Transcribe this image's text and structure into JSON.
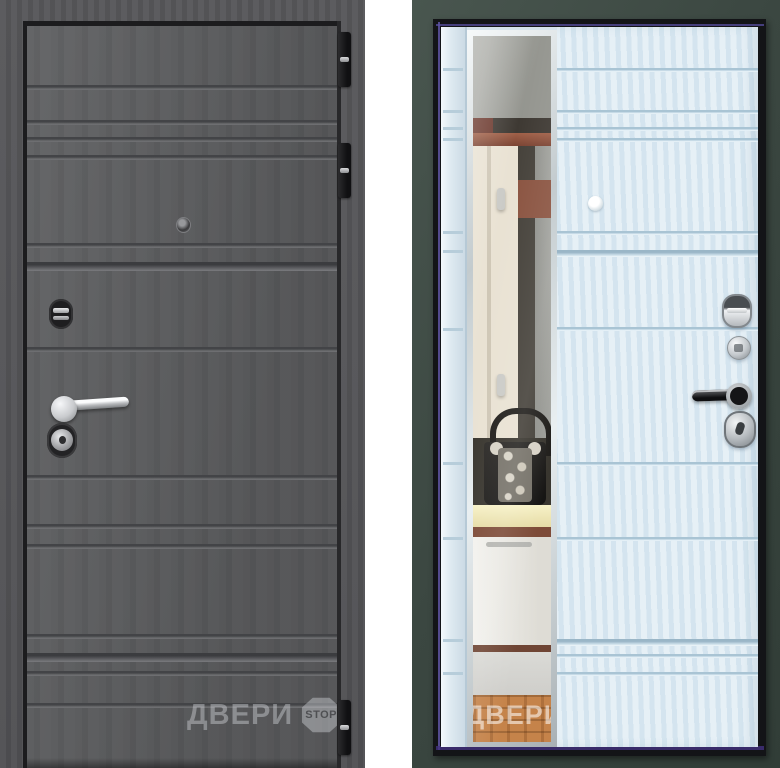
{
  "watermark": {
    "brand": "ДВЕРИ",
    "badge": "STOP"
  },
  "colors": {
    "left_leaf": "#5b5c5e",
    "left_frame": "#525255",
    "right_leaf": "#dceaf3",
    "right_frame": "#3e4a45",
    "edge_accent": "#5b50a8",
    "chrome": "#d7d9db",
    "mirror_wood_floor": "#c5834a"
  }
}
